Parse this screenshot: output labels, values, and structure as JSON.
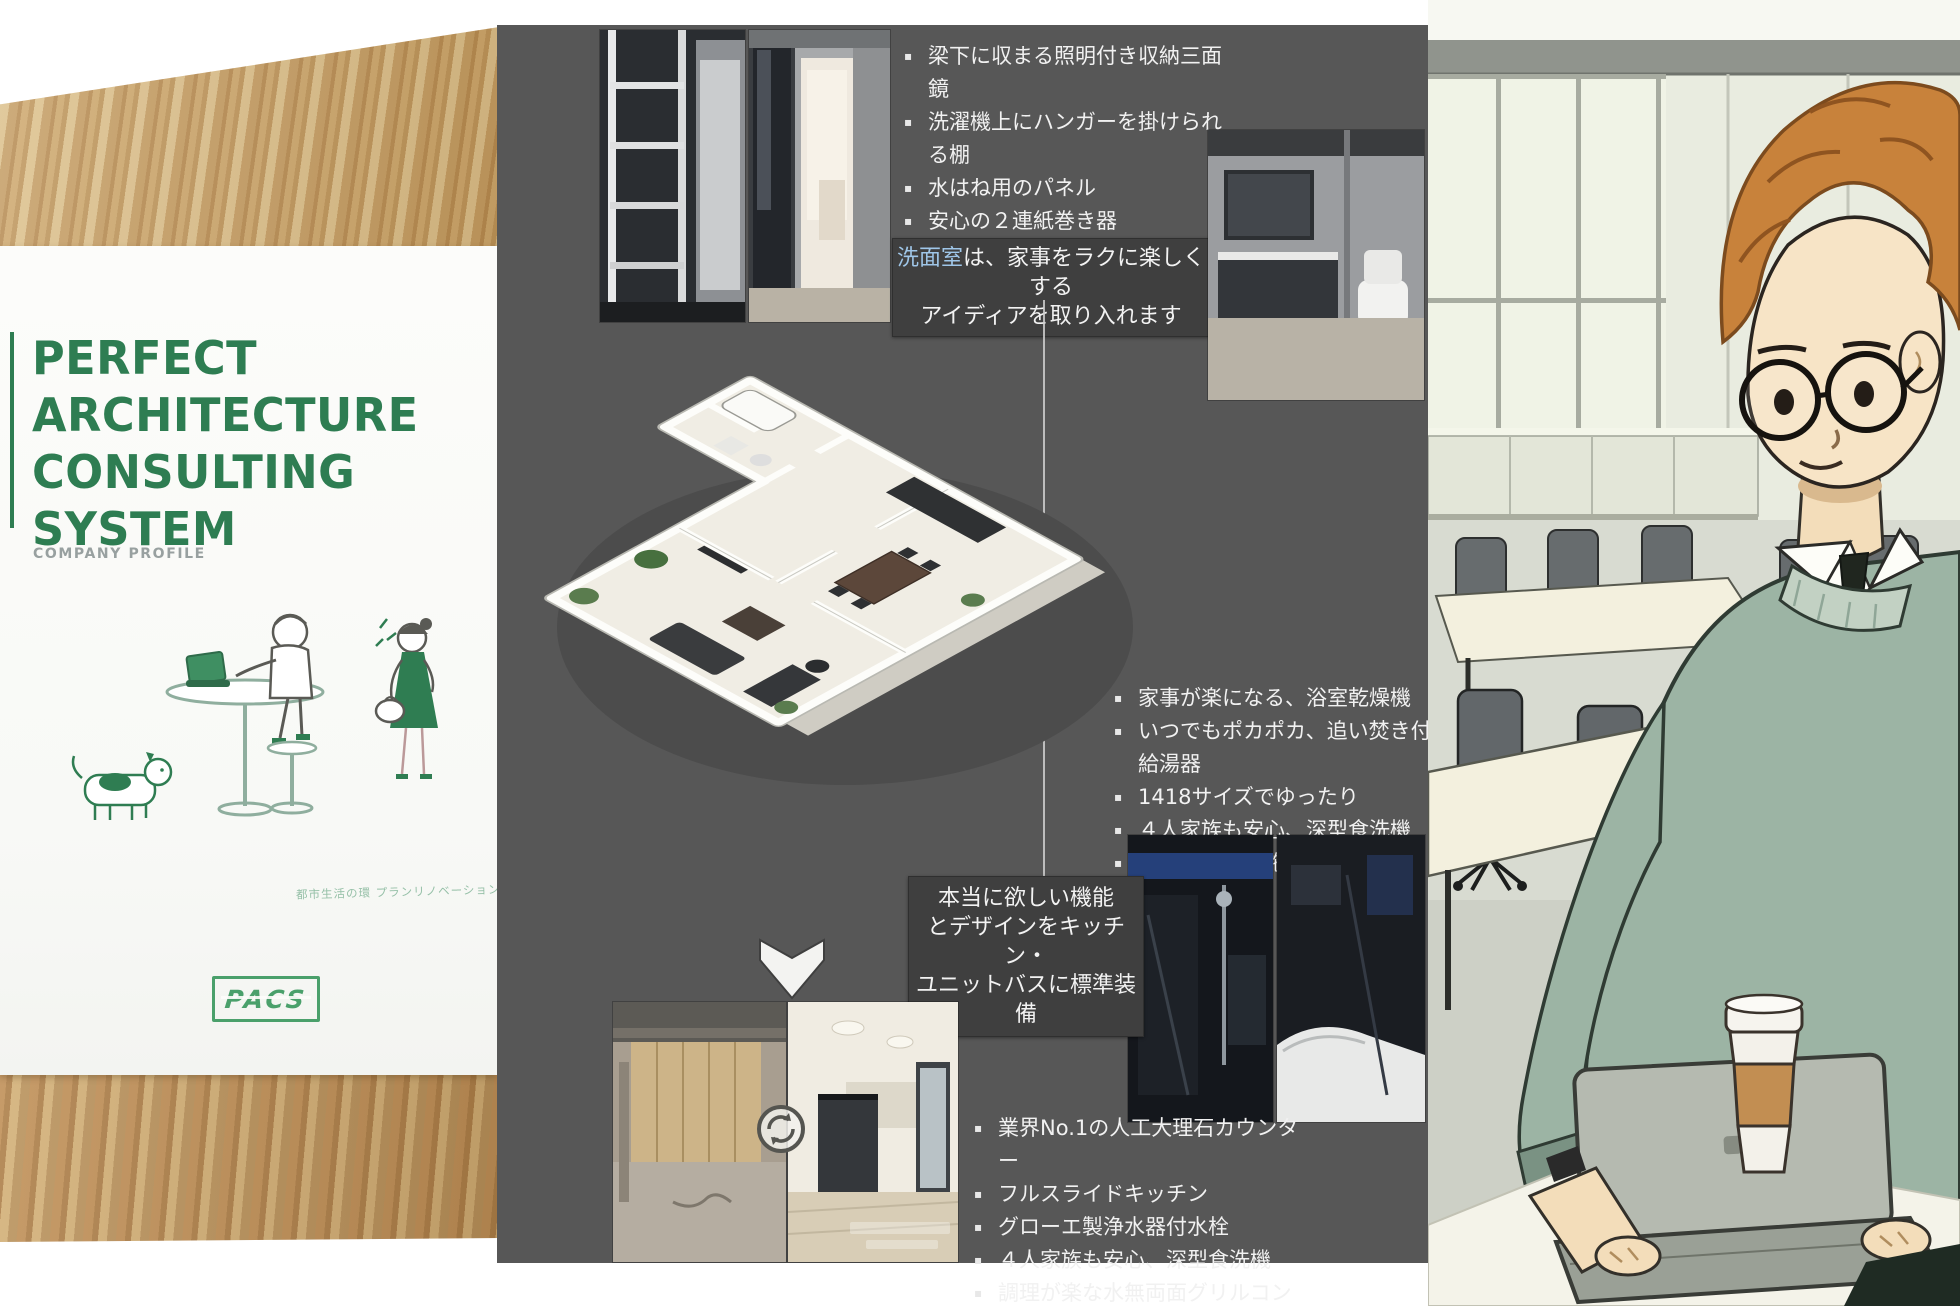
{
  "brochure": {
    "title1": "PERFECT",
    "title2": "ARCHITECTURE",
    "title3": "CONSULTING",
    "title4": "SYSTEM",
    "subtitle": "COMPANY PROFILE",
    "tagline": "都市生活の環 プランリノベーション",
    "logo_text": "PACS",
    "accent_color": "#2e7d52",
    "logo_color": "#4aa06b"
  },
  "slide": {
    "bg_color": "#575757",
    "callout_bg": "#3f3f3f",
    "text_color": "#f1f1f1",
    "bullets_top": {
      "items": [
        "梁下に収まる照明付き収納三面鏡",
        "洗濯機上にハンガーを掛けられる棚",
        "水はね用のパネル",
        "安心の２連紙巻き器",
        "便利なハンギングバーエアープランツも飾れます"
      ]
    },
    "callout_washroom": {
      "highlight": "洗面室",
      "line1_rest": "は、家事をラクに楽しくする",
      "line2": "アイディアを取り入れます"
    },
    "bullets_middle": {
      "items": [
        "家事が楽になる、浴室乾燥機",
        "いつでもポカポカ、追い焚き付給湯器",
        "1418サイズでゆったり",
        "４人家族も安心、深型食洗機",
        "裏もしっかり施工"
      ]
    },
    "callout_kitchen": {
      "line1": "本当に欲しい機能",
      "line2": "とデザインをキッチン・",
      "line3": "ユニットバスに標準装備"
    },
    "bullets_bottom": {
      "items": [
        "業界No.1の人工大理石カウンター",
        "フルスライドキッチン",
        "グローエ製浄水器付水栓",
        "４人家族も安心、深型食洗機",
        "調理が楽な水無両面グリルコンロ他"
      ]
    }
  },
  "illustration": {
    "sweater_color": "#9cb4a4",
    "hair_color": "#c8823b",
    "wall_color": "#e9ece0",
    "table_color": "#f3f0de",
    "cup_sleeve_color": "#c28e52"
  }
}
